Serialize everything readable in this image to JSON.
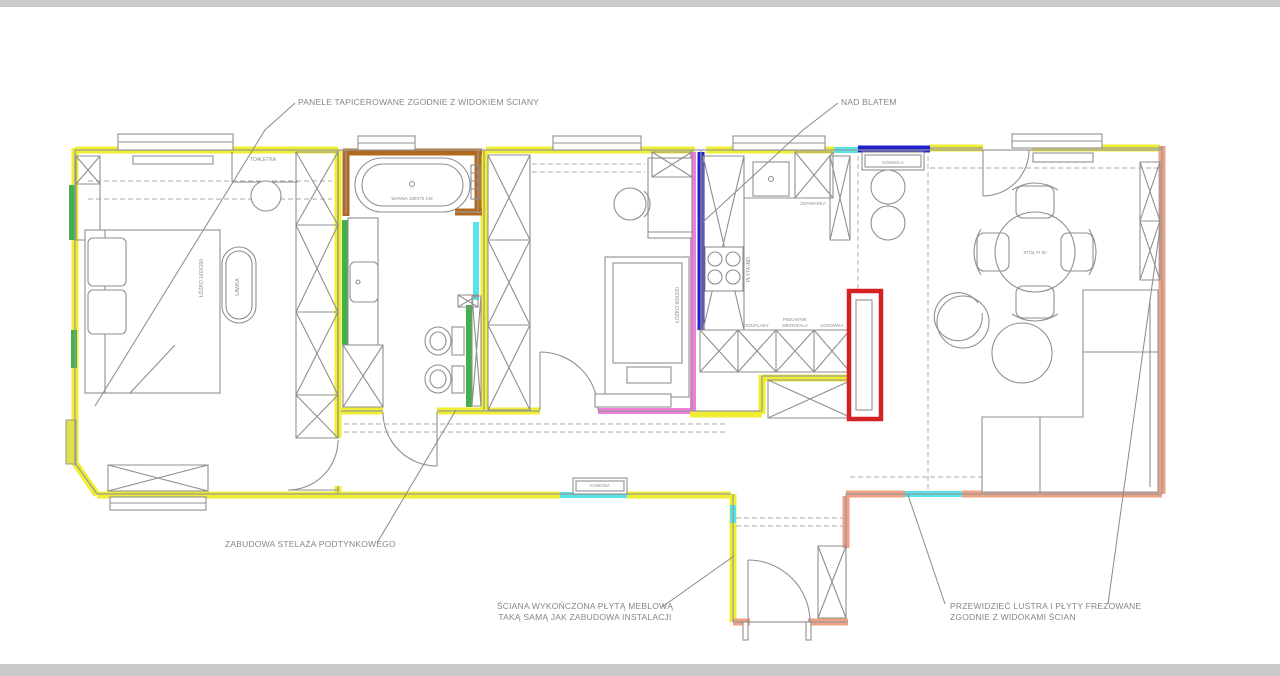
{
  "palette": {
    "yellow": "#f0ee30",
    "cyan": "#55e4e8",
    "green": "#44b04c",
    "blue": "#2020cc",
    "pink": "#ef7fd9",
    "red": "#d42222",
    "brown": "#b2691f",
    "salmon": "#efa183",
    "olive": "#e0e04a",
    "wallline": "#9a9a9a",
    "graybar": "#c9c9c9"
  },
  "annotations": {
    "panele": "PANELE TAPICEROWANE ZGODNIE Z WIDOKIEM ŚCIANY",
    "nad_blatem": "NAD BLATEM",
    "zabudowa": "ZABUDOWA STELAŻA PODTYNKOWEGO",
    "sciana_1": "ŚCIANA WYKOŃCZONA PŁYTĄ MEBLOWĄ",
    "sciana_2": "TAKĄ SAMĄ JAK ZABUDOWA INSTALACJI",
    "lustra_1": "PRZEWIDZIEĆ LUSTRA I PŁYTY FREZOWANE",
    "lustra_2": "ZGODNIE Z WIDOKAMI ŚCIAN"
  },
  "labels": {
    "toaletka": "TOALETKA",
    "komoda": "KOMODA",
    "wanna": "WANNA 180X75 CM",
    "lozko1": "ŁÓŻKO 160X200",
    "lawka": "ŁAWKA",
    "lozko2": "ŁÓŻKO 90X200",
    "plyta": "PŁYTA IND.",
    "zmywarka": "ZMYWARKA",
    "szuflady": "SZUFLADY",
    "piekarnik": "PIEKARNIK",
    "mikrofala": "MIKROFALA",
    "lodowka": "LODÓWKA",
    "stol": "STÓŁ FI 90",
    "konsola": "KONSOLA"
  }
}
